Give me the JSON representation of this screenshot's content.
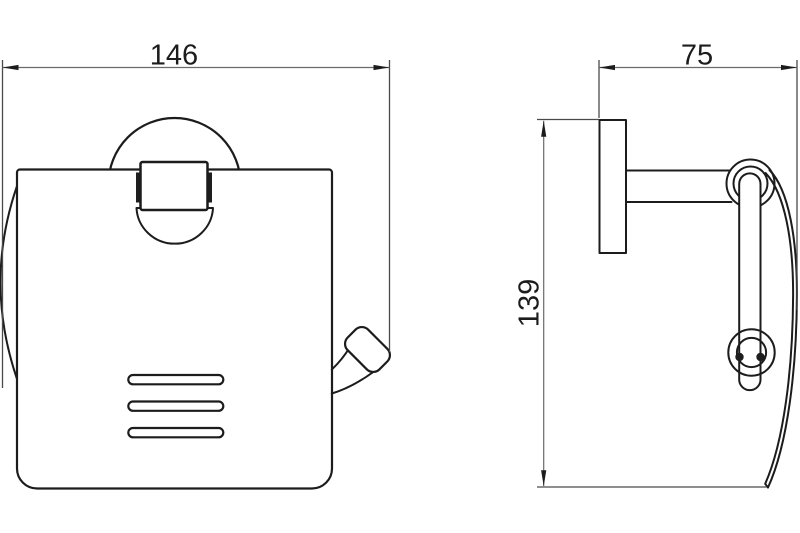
{
  "drawing": {
    "type": "technical-line-drawing",
    "subject": "wall-mounted toilet paper holder with cover, front view and side view",
    "dimensions": {
      "overall_width": {
        "value": "146"
      },
      "depth": {
        "value": "75"
      },
      "height": {
        "value": "139"
      }
    },
    "colors": {
      "background": "#ffffff",
      "object_line": "#1c1c1c",
      "dimension_line": "#6a6a6a",
      "extension_line": "#4a4a4a",
      "text": "#1c1c1c",
      "latch_tab_fill": "#1e1e1e"
    }
  }
}
